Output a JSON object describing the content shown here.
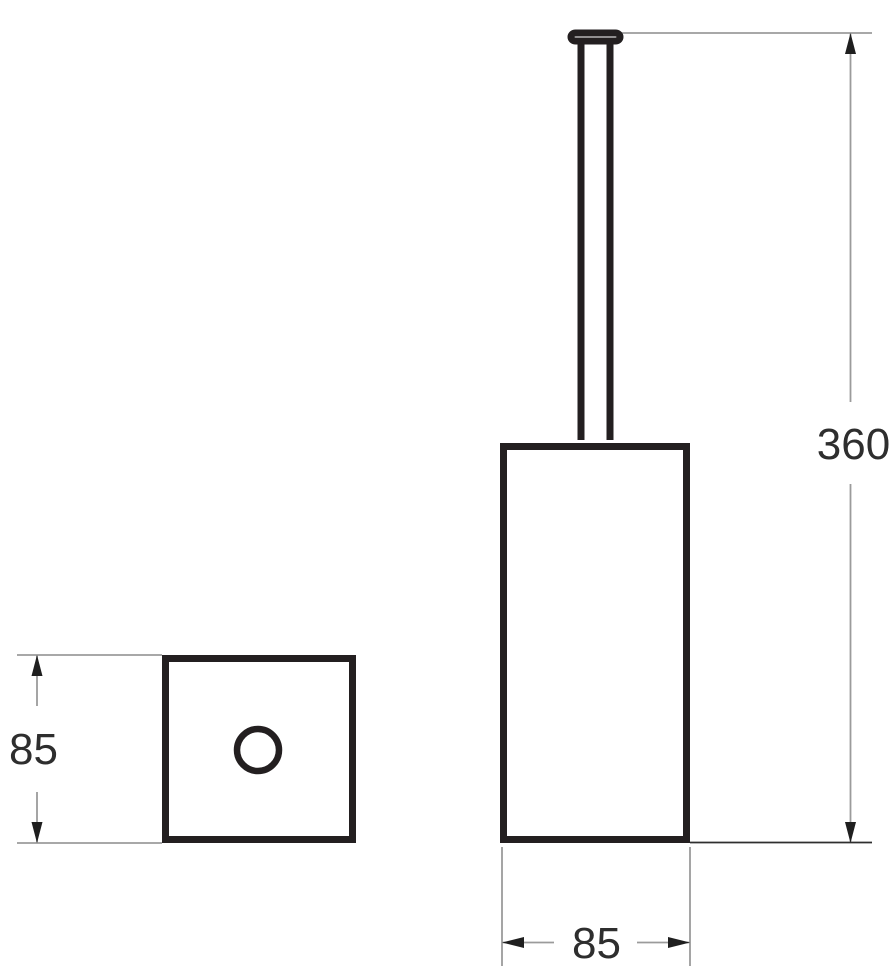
{
  "drawing": {
    "views": {
      "front_view": "toilet-brush-holder-front-elevation",
      "top_view": "toilet-brush-holder-plan-square-with-hole"
    },
    "dimensions": {
      "height": {
        "label": "360"
      },
      "width": {
        "label": "85"
      },
      "depth": {
        "label": "85"
      }
    }
  },
  "colors": {
    "background": "#ffffff",
    "object_line": "#231f20",
    "dim_line": "#9b9b9b",
    "dark_ext_line": "#2f2f2f",
    "arrow": "#1f1f1f",
    "label_text": "#2e2e2e"
  }
}
